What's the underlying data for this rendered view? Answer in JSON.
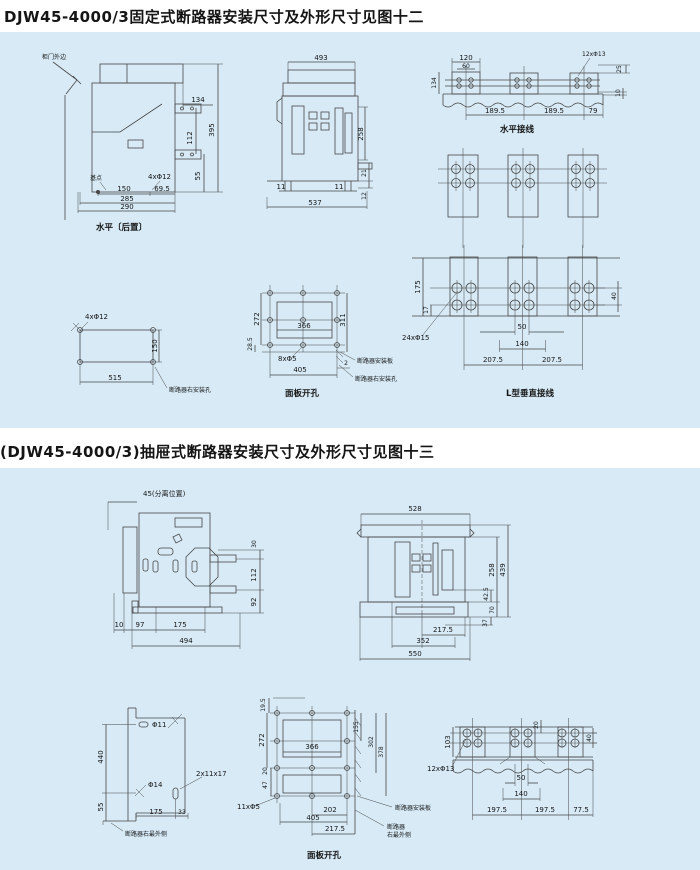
{
  "page": {
    "bg": "#ffffff",
    "panel_bg": "#d7eaf6",
    "line_color": "#474747",
    "ink": "#161616"
  },
  "fixed": {
    "title": "DJW45-4000/3固定式断路器安装尺寸及外形尺寸见图十二",
    "side": {
      "door_edge": "柜门外边",
      "base_point": "基点",
      "holes": "4xΦ12",
      "caption": "水平〔后置〕",
      "d134": "134",
      "d112": "112",
      "d55": "55",
      "d395": "395",
      "d150": "150",
      "d69_5": "69.5",
      "d285": "285",
      "d290": "290"
    },
    "front": {
      "d493": "493",
      "d258": "258",
      "d21": "21",
      "d12": "12",
      "d11": "11",
      "d537": "537"
    },
    "hwire": {
      "caption": "水平接线",
      "holes": "12xΦ13",
      "d120": "120",
      "d60": "60",
      "d134": "134",
      "d25": "25",
      "d10": "10",
      "d189_5": "189.5",
      "d79": "79"
    },
    "rmount": {
      "holes": "4xΦ12",
      "label": "断路器右安装孔",
      "d150": "150",
      "d515": "515"
    },
    "cutout": {
      "caption": "面板开孔",
      "holes": "8xΦ5",
      "plate_label": "断路器安装板",
      "hole_label": "断路器右安装孔",
      "d272": "272",
      "d366": "366",
      "d311": "311",
      "d28_5": "28.5",
      "d405": "405",
      "d2": "2"
    },
    "lwire": {
      "caption": "L型垂直接线",
      "holes": "24xΦ15",
      "d175": "175",
      "d17": "17",
      "d50": "50",
      "d140": "140",
      "d207_5": "207.5",
      "d40": "40"
    }
  },
  "drawer": {
    "title": "(DJW45-4000/3)抽屉式断路器安装尺寸及外形尺寸见图十三",
    "side": {
      "sep": "45(分离位置)",
      "d30": "30",
      "d112": "112",
      "d92": "92",
      "d10": "10",
      "d97": "97",
      "d175": "175",
      "d494": "494"
    },
    "front": {
      "d528": "528",
      "d258": "258",
      "d439": "439",
      "d42_5": "42.5",
      "d70": "70",
      "d37": "37",
      "d217_5": "217.5",
      "d352": "352",
      "d550": "550"
    },
    "mount": {
      "label": "断路器右最外侧",
      "phi11": "Φ11",
      "phi14": "Φ14",
      "slot": "2x11x17",
      "d440": "440",
      "d55": "55",
      "d175": "175",
      "d33": "33"
    },
    "cutout": {
      "caption": "面板开孔",
      "holes": "11xΦ5",
      "plate_label": "断路器安装板",
      "edge_label1": "断路器",
      "edge_label2": "右最外侧",
      "d19_5": "19.5",
      "d272": "272",
      "d366": "366",
      "d155": "155",
      "d302": "302",
      "d378": "378",
      "d20": "20",
      "d47": "47",
      "d202": "202",
      "d405": "405",
      "d217_5": "217.5"
    },
    "vwire": {
      "holes": "12xΦ13",
      "d103": "103",
      "d20": "20",
      "d40": "40",
      "d50": "50",
      "d140": "140",
      "d197_5": "197.5",
      "d77_5": "77.5"
    }
  }
}
